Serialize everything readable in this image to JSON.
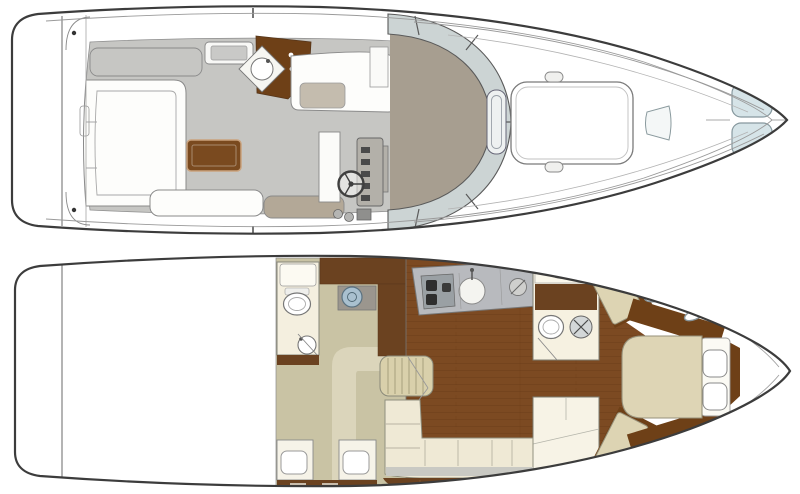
{
  "figure": {
    "kind": "yacht floor plan, two deck top-views, bow pointing right",
    "views": [
      {
        "name": "main-deck-plan",
        "features": [
          "swim-platform",
          "transom-gate",
          "cockpit-settee",
          "cockpit-table",
          "aft-bench",
          "sun-bench",
          "icebox-module",
          "wet-bar",
          "bar-sink",
          "helm-console",
          "steering-wheel",
          "throttle-controls",
          "companion-seat",
          "wraparound-windshield",
          "windshield-grab-rail",
          "foredeck-sun-pad",
          "cleats",
          "foredeck-hatch",
          "bow-deck-hatches"
        ]
      },
      {
        "name": "lower-deck-plan",
        "features": [
          "engine-space",
          "aft-head",
          "toilet",
          "head-counter",
          "head-sink",
          "vanity-sink",
          "aft-cabin-carpet",
          "walkway",
          "wardrobe",
          "twin-berths",
          "pillows",
          "drawer-bank",
          "companionway-steps",
          "galley-counter",
          "stove-burners",
          "galley-sink",
          "salon-wood-floor",
          "salon-settee",
          "settee-cabinet",
          "mid-head",
          "toilet",
          "vanity-basin",
          "shower",
          "guest-berth-aft",
          "guest-berth-forward",
          "forward-island-bed",
          "bed-pillows",
          "hull-portlights"
        ]
      }
    ]
  },
  "palette": {
    "outline": "#3c3c3c",
    "hull_white": "#ffffff",
    "deck_gray": "#c6c6c3",
    "taupe": "#a79e90",
    "glass": "#ccd4d4",
    "table_wood": "#7a4a1f",
    "bar_wood": "#6e4017",
    "cab_wood": "#6b4220",
    "trim_wood": "#6e4017",
    "floor_wood": "#7c4a22",
    "plank_line": "#6a3c19",
    "carpet": "#c9c3a4",
    "carpet_path": "#dbd5bb",
    "berth": "#ddd4b3",
    "bed": "#ded5b5",
    "cream": "#efe9d5",
    "counter": "#b8babe",
    "sink_metal": "#a9c0cf",
    "hatch": "#d6e4e8",
    "bench_taupe": "#b3a897",
    "steps": "#d9d0ab"
  }
}
